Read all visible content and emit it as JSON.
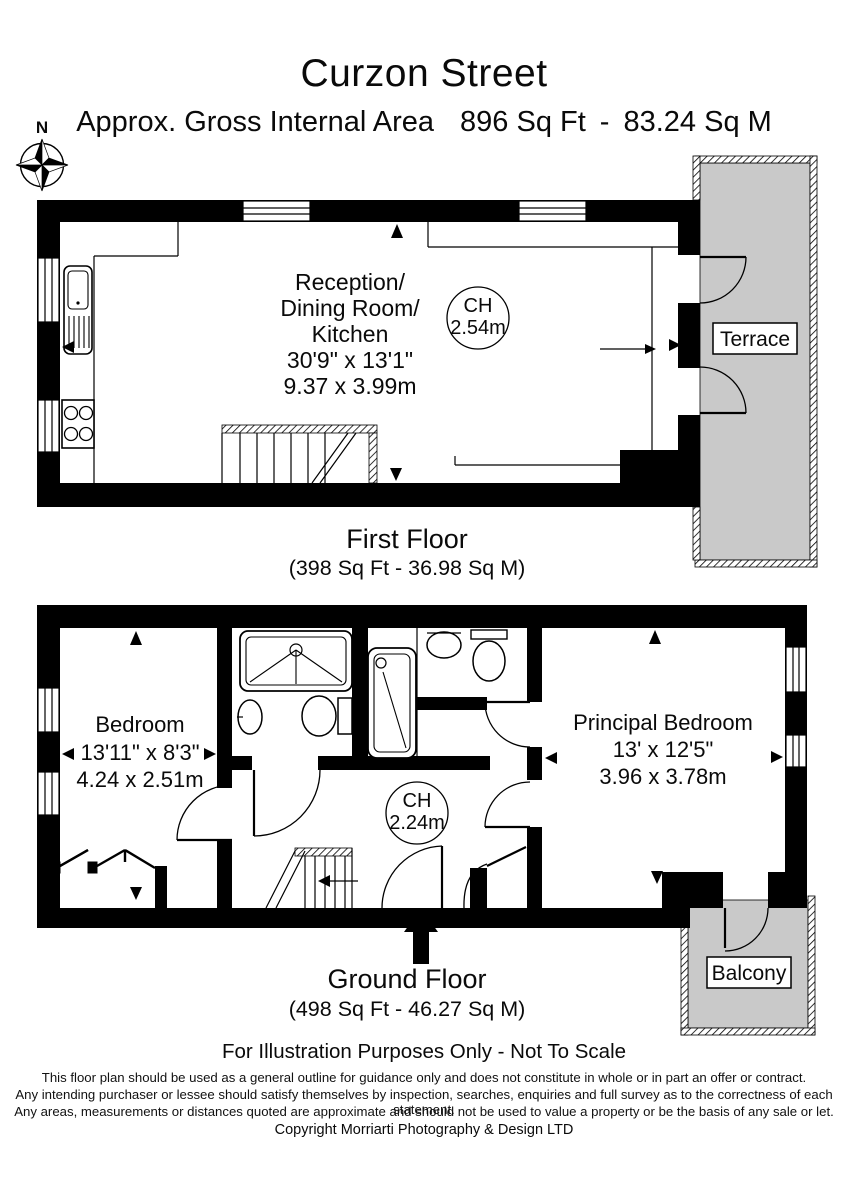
{
  "header": {
    "title": "Curzon Street",
    "subtitle_prefix": "Approx. Gross Internal Area",
    "subtitle_imperial": "896 Sq Ft",
    "subtitle_separator": "-",
    "subtitle_metric": "83.24 Sq M",
    "compass": "N"
  },
  "first_floor": {
    "caption": "First Floor",
    "area": "(398 Sq Ft - 36.98 Sq M)",
    "room_line1": "Reception/",
    "room_line2": "Dining Room/",
    "room_line3": "Kitchen",
    "room_dims_ft": "30'9\" x 13'1\"",
    "room_dims_m": "9.37 x 3.99m",
    "ch_label": "CH",
    "ch_value": "2.54m",
    "terrace": "Terrace"
  },
  "ground_floor": {
    "caption": "Ground Floor",
    "area": "(498 Sq Ft - 46.27 Sq M)",
    "bedroom_name": "Bedroom",
    "bedroom_dims_ft": "13'11\" x 8'3\"",
    "bedroom_dims_m": "4.24 x 2.51m",
    "principal_name": "Principal Bedroom",
    "principal_dims_ft": "13' x 12'5\"",
    "principal_dims_m": "3.96 x 3.78m",
    "ch_label": "CH",
    "ch_value": "2.24m",
    "balcony": "Balcony"
  },
  "footer": {
    "notice": "For Illustration Purposes Only - Not To Scale",
    "disclaimer1": "This floor plan should be used as a general outline for guidance only and does not constitute in whole or in part an offer or contract.",
    "disclaimer2": "Any intending purchaser or lessee should satisfy themselves by inspection, searches, enquiries and full survey as to the correctness of each statement.",
    "disclaimer3": "Any areas, measurements or distances quoted are approximate and should not be used to value a property or be the basis of any sale or let.",
    "copyright": "Copyright Morriarti Photography & Design LTD"
  },
  "colors": {
    "wall": "#000000",
    "outdoor": "#c9c9c9",
    "background": "#ffffff"
  }
}
